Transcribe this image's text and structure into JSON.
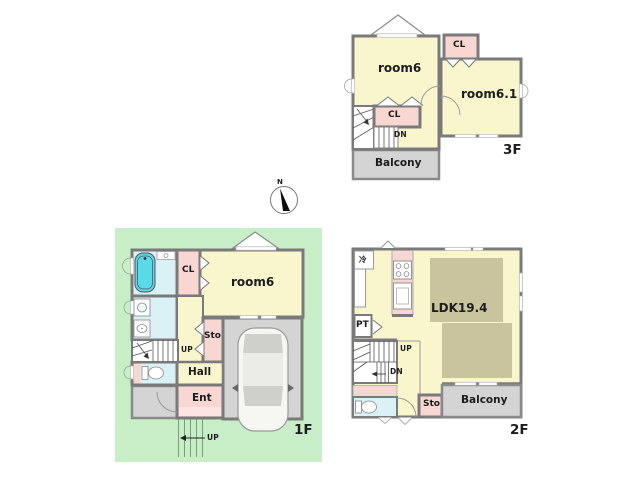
{
  "floor3": {
    "tag": "3F",
    "room6": "room6",
    "closet_top": "CL",
    "room6_1": "room6.1",
    "closet": "CL",
    "down": "DN",
    "balcony": "Balcony"
  },
  "floor1": {
    "tag": "1F",
    "closet": "CL",
    "room6": "room6",
    "storage": "Sto",
    "up": "UP",
    "hall": "Hall",
    "entrance": "Ent",
    "approach_up": "UP"
  },
  "floor2": {
    "tag": "2F",
    "refrigerator": "冷",
    "pantry": "PT",
    "ldk": "LDK19.4",
    "up": "UP",
    "down": "DN",
    "storage": "Sto",
    "balcony": "Balcony"
  },
  "compass": {
    "north": "N"
  },
  "colors": {
    "room_yellow": "#f9f6cd",
    "closet_pink": "#f8d7d2",
    "balcony_gray": "#d4d4d4",
    "lot_green": "#c8eec8",
    "wet_area_cyan": "#daf1f5",
    "bathtub_cyan": "#5ad9e9",
    "rug_beige": "#cac49e",
    "wall_gray": "#7a7a7a"
  }
}
